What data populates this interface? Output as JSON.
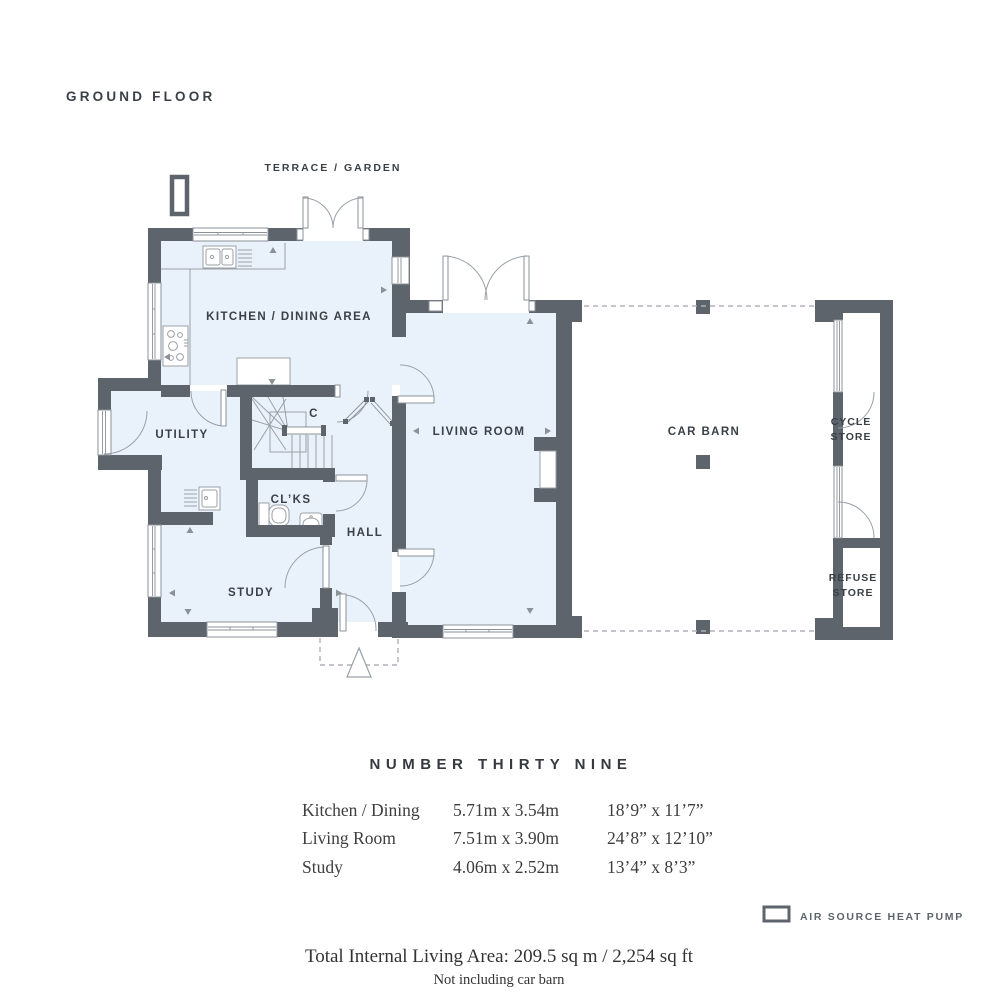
{
  "header": {
    "floor": "GROUND FLOOR"
  },
  "plan": {
    "terrace": "TERRACE / GARDEN",
    "rooms": {
      "kitchen": "KITCHEN / DINING AREA",
      "utility": "UTILITY",
      "cupboard": "C",
      "cloakroom": "CL’KS",
      "hall": "HALL",
      "study": "STUDY",
      "living_room": "LIVING ROOM",
      "car_barn": "CAR BARN",
      "cycle_store": [
        "CYCLE",
        "STORE"
      ],
      "refuse_store": [
        "REFUSE",
        "STORE"
      ]
    }
  },
  "details": {
    "title": "NUMBER THIRTY NINE",
    "rows": [
      {
        "room": "Kitchen / Dining",
        "metric": "5.71m x 3.54m",
        "imperial": "18’9” x 11’7”"
      },
      {
        "room": "Living Room",
        "metric": "7.51m x 3.90m",
        "imperial": "24’8” x 12’10”"
      },
      {
        "room": "Study",
        "metric": "4.06m x 2.52m",
        "imperial": "13’4” x 8’3”"
      }
    ],
    "legend_label": "AIR SOURCE HEAT PUMP",
    "total": "Total Internal Living Area: 209.5 sq m / 2,254 sq ft",
    "note": "Not including car barn"
  },
  "colors": {
    "wall": "#5d646c",
    "room_fill": "#e9f2fb",
    "line": "#9aa0a7",
    "text": "#3a4047"
  }
}
